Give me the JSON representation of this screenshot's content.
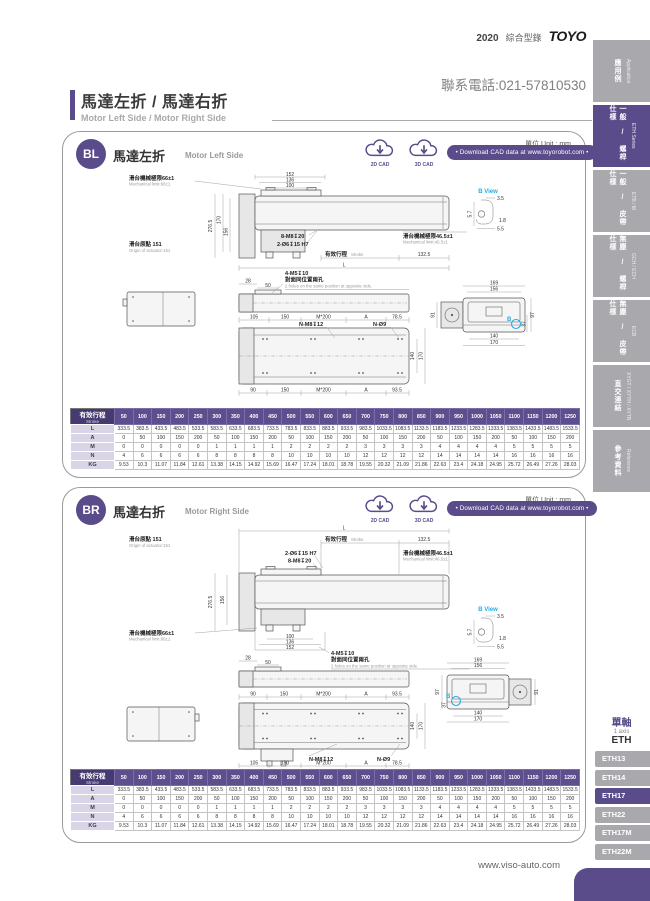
{
  "header": {
    "year": "2020",
    "catalog": "綜合型錄",
    "brand": "TOYO",
    "phone": "聯系電話:021-57810530"
  },
  "title": {
    "zh": "馬達左折 / 馬達右折",
    "en": "Motor Left Side / Motor Right Side"
  },
  "unit_label": "單位 Unit : mm",
  "cad": {
    "c2d": "2D CAD",
    "c3d": "3D CAD",
    "download": "• Download CAD data at www.toyorobot.com •"
  },
  "sections": {
    "bl": {
      "code": "BL",
      "zh": "馬達左折",
      "en": "Motor Left Side"
    },
    "br": {
      "code": "BR",
      "zh": "馬達右折",
      "en": "Motor Right Side"
    }
  },
  "labels": {
    "u152": "152",
    "u136": "136",
    "u100": "100",
    "u276": "276.5",
    "u170": "170",
    "u156": "156",
    "mech66": "滑台機械極限66±1",
    "mech66en": "Mechanical limit:66±1",
    "mech46": "滑台機械極限46.5±1",
    "mech46en": "Mechanical limit:46.5±1",
    "origin": "滑台原點 151",
    "originen": "Origin of actuator:151",
    "m8": "8-M8↧20",
    "o6": "2-Ø6↧15 H7",
    "m5": "4-M5↧10",
    "strokezh": "有效行程",
    "strokeen": "Stroke",
    "L": "L",
    "u1325": "132.5",
    "u28": "28",
    "u50": "50",
    "opp": "對面同位置兩孔",
    "oppen": "2 holes on the same position at opposite side.",
    "u105": "105",
    "u150": "150",
    "m200": "M*200",
    "A": "A",
    "u785": "78.5",
    "u90": "90",
    "u935": "93.5",
    "nm8": "N-M8↧12",
    "nd9": "N-Ø9",
    "u140": "140",
    "u169": "169",
    "u91": "91",
    "u97": "97",
    "u37": "37",
    "bview": "B View",
    "u35": "3.5",
    "u57": "5.7",
    "u18": "1.8",
    "u55": "5.5",
    "B": "B"
  },
  "table": {
    "corner_zh": "有效行程",
    "corner_en": "Stroke",
    "strokes": [
      "50",
      "100",
      "150",
      "200",
      "250",
      "300",
      "350",
      "400",
      "450",
      "500",
      "550",
      "600",
      "650",
      "700",
      "750",
      "800",
      "850",
      "900",
      "950",
      "1000",
      "1050",
      "1100",
      "1150",
      "1200",
      "1250"
    ],
    "rows": [
      {
        "label": "L",
        "values": [
          "333.5",
          "383.5",
          "433.5",
          "483.5",
          "533.5",
          "583.5",
          "633.5",
          "683.5",
          "733.5",
          "783.5",
          "833.5",
          "883.5",
          "933.5",
          "983.5",
          "1033.5",
          "1083.5",
          "1133.5",
          "1183.5",
          "1233.5",
          "1283.5",
          "1333.5",
          "1383.5",
          "1433.5",
          "1483.5",
          "1533.5"
        ]
      },
      {
        "label": "A",
        "values": [
          "0",
          "50",
          "100",
          "150",
          "200",
          "50",
          "100",
          "150",
          "200",
          "50",
          "100",
          "150",
          "200",
          "50",
          "100",
          "150",
          "200",
          "50",
          "100",
          "150",
          "200",
          "50",
          "100",
          "150",
          "200"
        ]
      },
      {
        "label": "M",
        "values": [
          "0",
          "0",
          "0",
          "0",
          "0",
          "1",
          "1",
          "1",
          "1",
          "2",
          "2",
          "2",
          "2",
          "3",
          "3",
          "3",
          "3",
          "4",
          "4",
          "4",
          "4",
          "5",
          "5",
          "5",
          "5"
        ]
      },
      {
        "label": "N",
        "values": [
          "4",
          "6",
          "6",
          "6",
          "6",
          "8",
          "8",
          "8",
          "8",
          "10",
          "10",
          "10",
          "10",
          "12",
          "12",
          "12",
          "12",
          "14",
          "14",
          "14",
          "14",
          "16",
          "16",
          "16",
          "16"
        ]
      },
      {
        "label": "KG",
        "values": [
          "9.53",
          "10.3",
          "11.07",
          "11.84",
          "12.61",
          "13.38",
          "14.15",
          "14.92",
          "15.69",
          "16.47",
          "17.24",
          "18.01",
          "18.78",
          "19.55",
          "20.32",
          "21.09",
          "21.86",
          "22.63",
          "23.4",
          "24.18",
          "24.95",
          "25.72",
          "26.49",
          "27.26",
          "28.03"
        ]
      }
    ]
  },
  "sidebar": {
    "tabs": [
      {
        "zh": "應用例",
        "en": "Application",
        "active": false
      },
      {
        "zh": "一般 / 螺桿仕樣",
        "en": "ETH Series",
        "active": true
      },
      {
        "zh": "一般 / 皮帶仕樣",
        "en": "ETB / M",
        "active": false
      },
      {
        "zh": "無塵 / 螺桿仕樣",
        "en": "GCH / ECH",
        "active": false
      },
      {
        "zh": "無塵 / 皮帶仕樣",
        "en": "ECB",
        "active": false
      },
      {
        "zh": "直交連結",
        "en": "XYGT / XYTH / XYTB",
        "active": false
      },
      {
        "zh": "參考資料",
        "en": "Reference",
        "active": false
      }
    ]
  },
  "eth_menu": {
    "axis_zh": "單軸",
    "axis_en": "1 axis",
    "model": "ETH",
    "items": [
      {
        "label": "ETH13",
        "active": false
      },
      {
        "label": "ETH14",
        "active": false
      },
      {
        "label": "ETH17",
        "active": true
      },
      {
        "label": "ETH22",
        "active": false
      },
      {
        "label": "ETH17M",
        "active": false
      },
      {
        "label": "ETH22M",
        "active": false
      }
    ]
  },
  "footer": {
    "site": "www.viso-auto.com"
  },
  "colors": {
    "purple": "#5a4b8a",
    "tab_gray": "#a8a8ad",
    "view_blue": "#29abe2"
  }
}
